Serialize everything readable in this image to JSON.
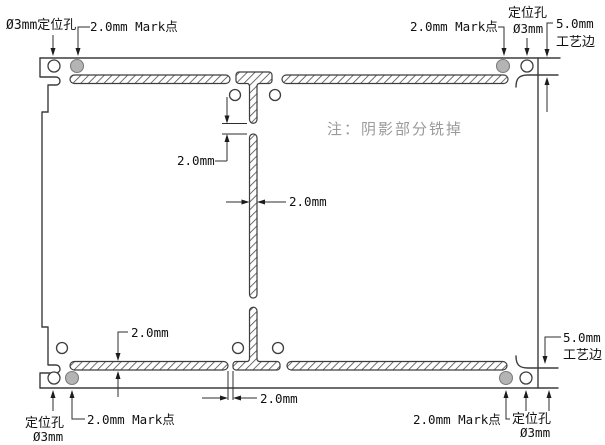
{
  "drawing": {
    "note": "注：阴影部分铣掉",
    "labels": {
      "top_left_hole": "Ø3mm定位孔",
      "top_left_mark": "2.0mm Mark点",
      "top_right_mark": "2.0mm Mark点",
      "top_right_hole_line1": "定位孔",
      "top_right_hole_line2": "Ø3mm",
      "top_right_edge_line1": "5.0mm",
      "top_right_edge_line2": "工艺边",
      "bottom_left_hole_line1": "定位孔",
      "bottom_left_hole_line2": "Ø3mm",
      "bottom_left_mark": "2.0mm Mark点",
      "bottom_right_mark": "2.0mm Mark点",
      "bottom_right_hole_line1": "定位孔",
      "bottom_right_hole_line2": "Ø3mm",
      "bottom_right_edge_line1": "5.0mm",
      "bottom_right_edge_line2": "工艺边"
    },
    "dimensions": {
      "top_center_gap": "2.0mm",
      "center_bar_width": "2.0mm",
      "bottom_strip_height": "2.0mm",
      "bottom_center_gap": "2.0mm"
    },
    "features": {
      "positioning_holes": 4,
      "mark_points": 4,
      "board_corner_holes": 5
    },
    "colors": {
      "line": "#3d3d3d",
      "hatch": "#4a4a4a",
      "mark_point_fill": "#b4b4b4",
      "note_text": "#9a9a9a"
    }
  }
}
